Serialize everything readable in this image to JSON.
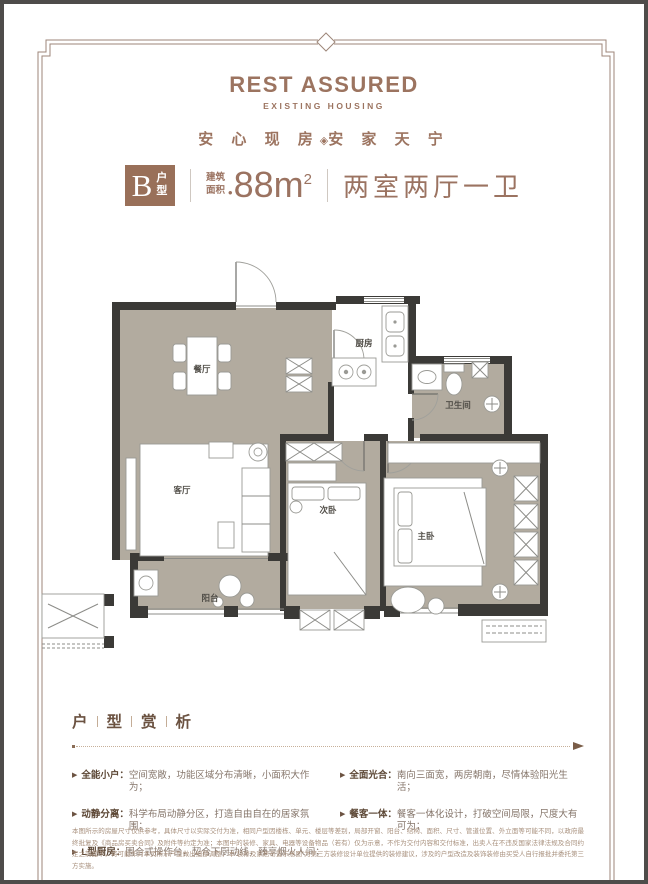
{
  "brand": {
    "title": "REST ASSURED",
    "subtitle": "EXISTING HOUSING",
    "tagline_left": "安 心 现 房",
    "tagline_sep": "◈",
    "tagline_right": "安 家 天 宁"
  },
  "unit": {
    "type_letter": "B",
    "type_suffix": "户型",
    "area_label_top": "建筑",
    "area_label_bottom": "面积",
    "area_dot": "•",
    "area_value": "88m",
    "area_exponent": "2",
    "rooms_summary": "两室两厅一卫"
  },
  "floorplan": {
    "labels": {
      "dining": "餐厅",
      "kitchen": "厨房",
      "bathroom": "卫生间",
      "living": "客厅",
      "bedroom2": "次卧",
      "master": "主卧",
      "balcony": "阳台"
    }
  },
  "analysis": {
    "heading_chars": [
      "户",
      "型",
      "赏",
      "析"
    ],
    "marker": "▶",
    "left_bullets": [
      {
        "label": "全能小户：",
        "text": "空间宽敞，功能区域分布清晰，小面积大作为；"
      },
      {
        "label": "动静分离：",
        "text": "科学布局动静分区，打造自由自在的居家氛围；"
      },
      {
        "label": "L型厨房：",
        "text": "围合式操作台，契合下厨动线，臻享烟火人间；"
      }
    ],
    "right_bullets": [
      {
        "label": "全面光合：",
        "text": "南向三面宽，两房朝南，尽情体验阳光生活；"
      },
      {
        "label": "餐客一体：",
        "text": "餐客一体化设计，打破空间局限，尺度大有可为；"
      }
    ]
  },
  "disclaimer": "本图所示的房屋尺寸仅供参考，具体尺寸以实际交付为准，相同户型因楼栋、单元、楼层等差别，局部开窗、阳台、结构、面积、尺寸、管道位置、外立面等可能不同，以政府最终批复及《商品房买卖合同》及附件等约定为准；本图中的装修、家具、电器等设备物品（若有）仅为示意，不作为交付内容和交付标准，出卖人在不违反国家法律法规及合同约定之前提下，将可能作对本页所示户型做出细部调整，本“装修及家居布置示意图”为第三方装修设计单位提供的装修建议，涉及的户型改造及装饰装修由买受人自行报批并委托第三方实施。",
  "colors": {
    "brand_brown": "#9c7460",
    "wall_dark": "#3b3a37",
    "floor_taupe": "#b2ab9f"
  }
}
